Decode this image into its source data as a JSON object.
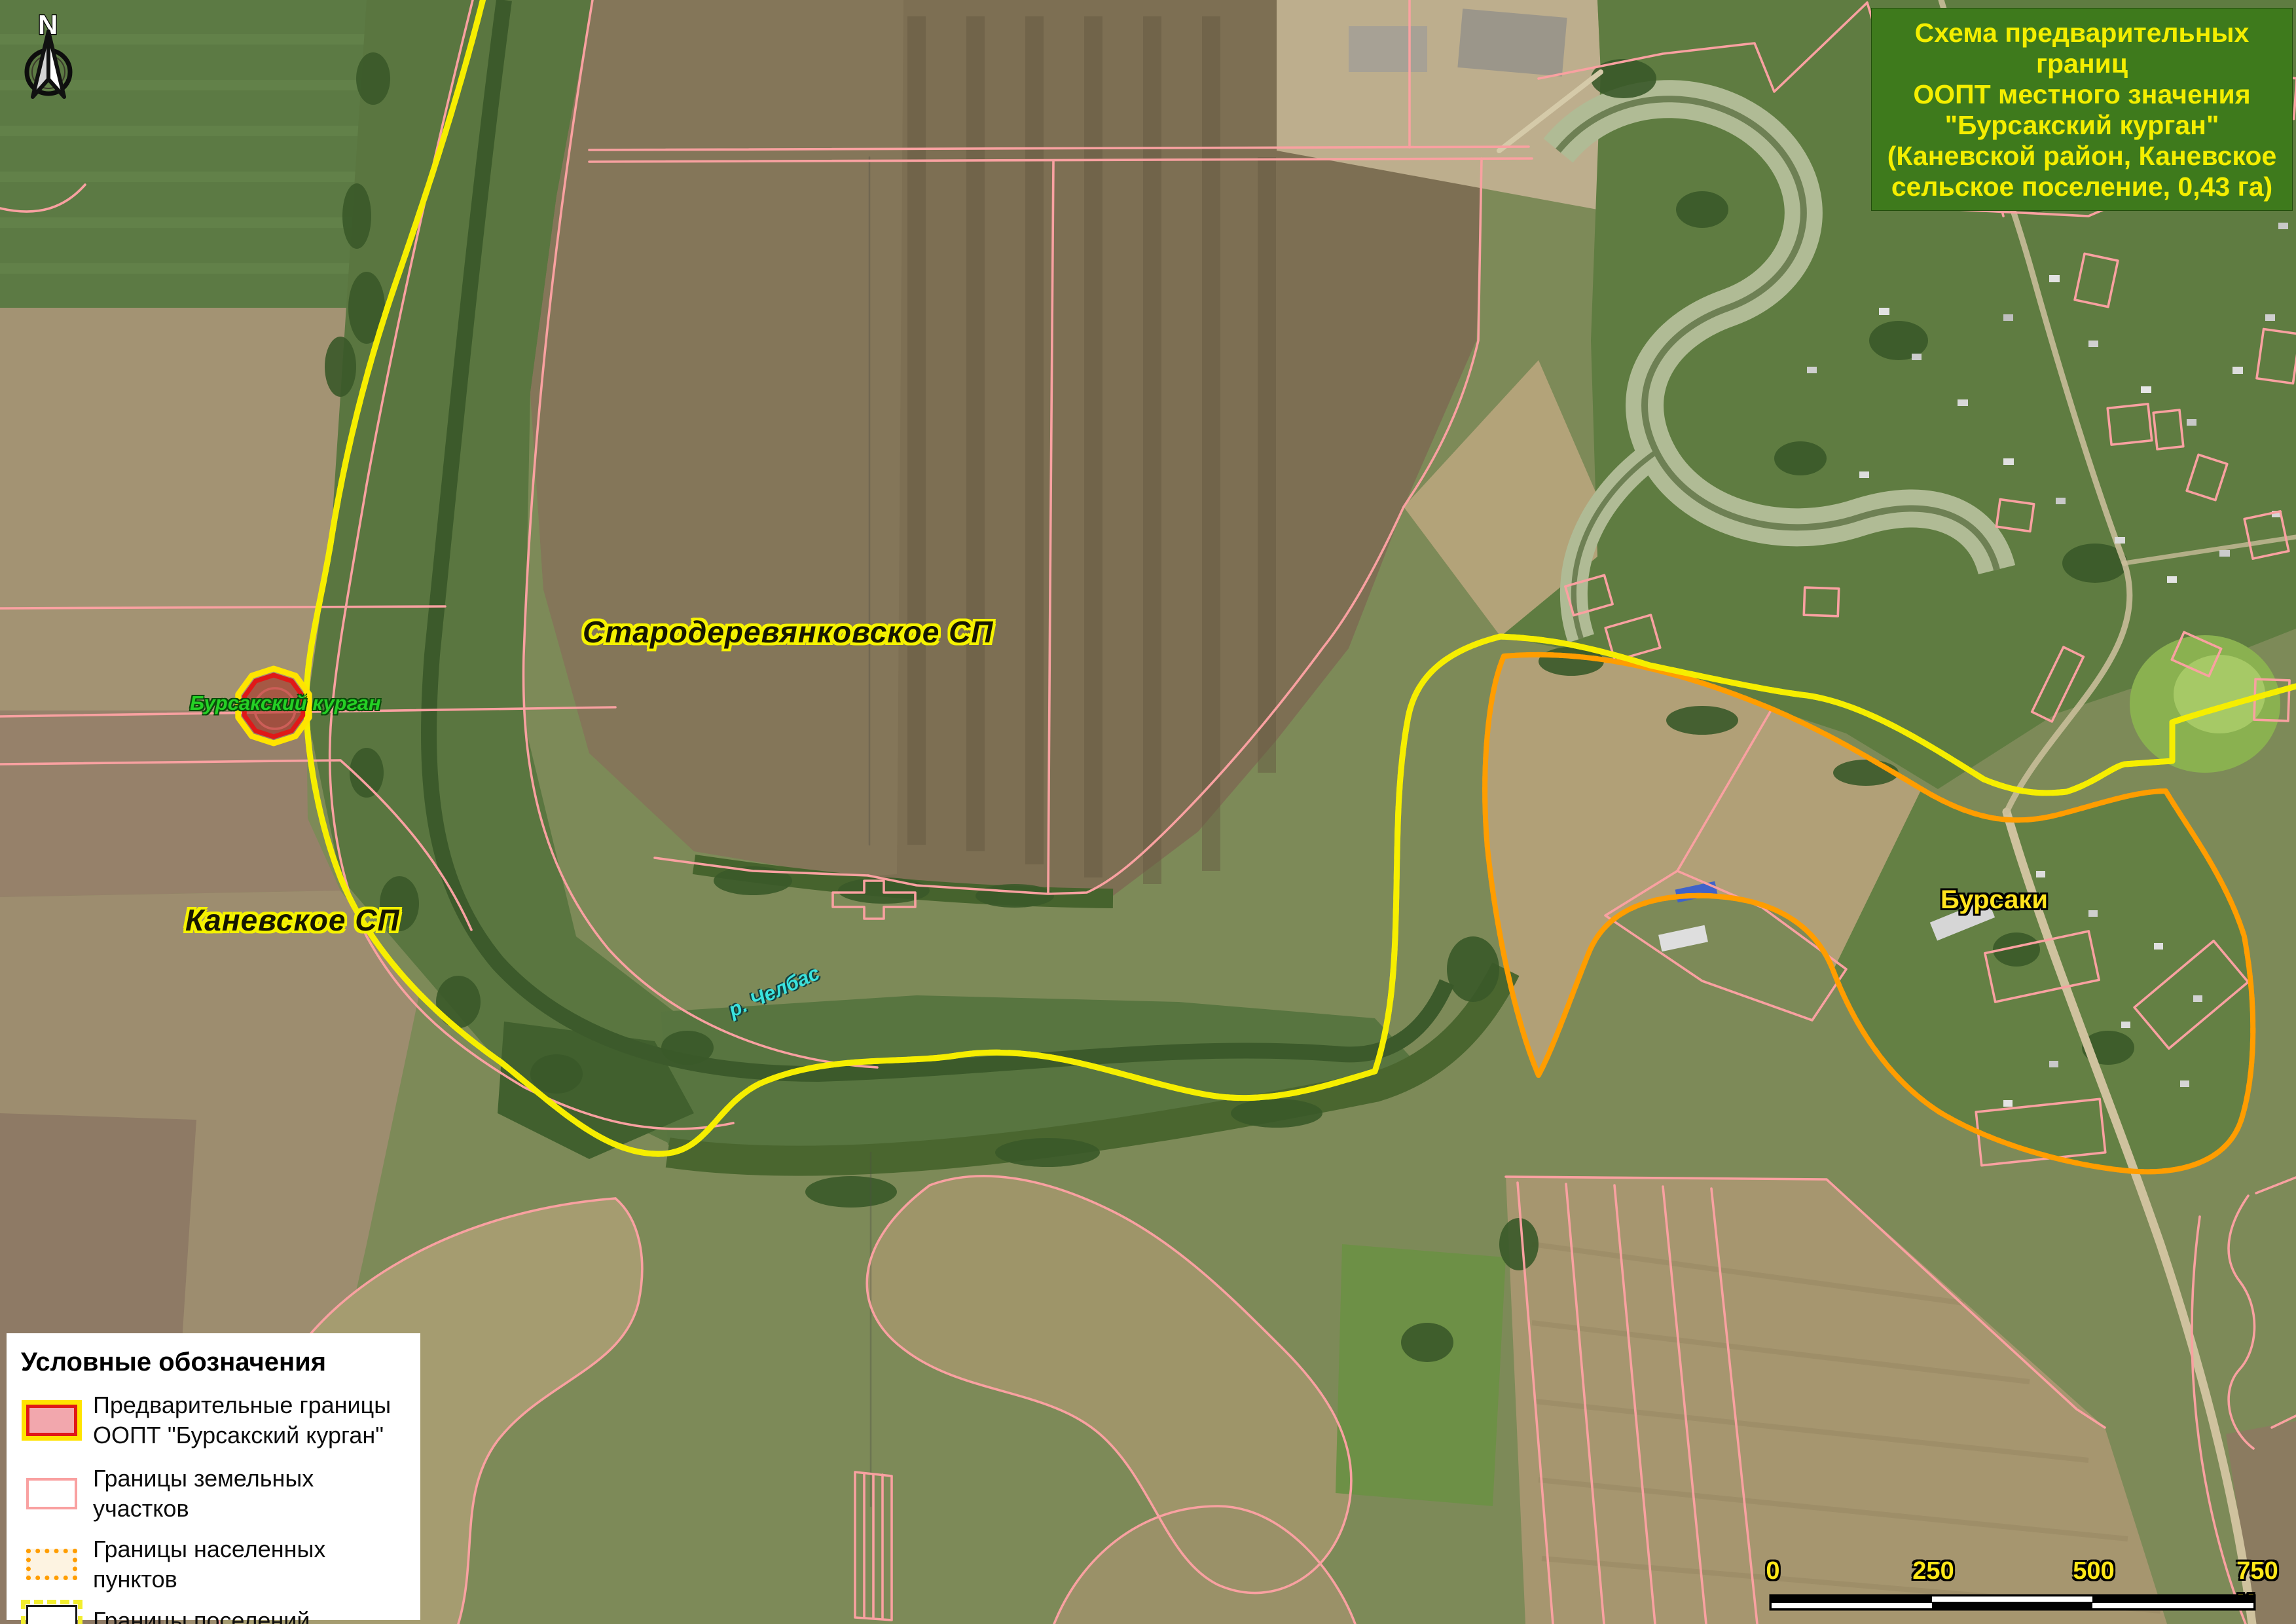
{
  "page": {
    "type": "protected-area-boundary-scheme-map"
  },
  "title_box": {
    "lines": [
      "Схема предварительных границ",
      "ООПТ местного значения",
      "\"Бурсакский курган\"",
      "(Каневской район, Каневское",
      "сельское поселение, 0,43 га)"
    ]
  },
  "north_arrow": {
    "label": "N"
  },
  "map_labels": {
    "settlement_area_1": "Стародеревянковское СП",
    "settlement_area_2": "Каневское СП",
    "oopt_marker": "Бурсакский курган",
    "river": "р. Челбас",
    "village": "Бурсаки"
  },
  "legend": {
    "title": "Условные обозначения",
    "items": [
      {
        "label_line1": "Предварительные границы",
        "label_line2": "ООПТ \"Бурсакский курган\""
      },
      {
        "label_line1": "Границы земельных участков"
      },
      {
        "label_line1": "Границы населенных пунктов"
      },
      {
        "label_line1": "Границы поселений"
      }
    ]
  },
  "scale_bar": {
    "labels": [
      "0",
      "250",
      "500",
      "750 м"
    ]
  },
  "colors": {
    "parcel": "#f9a1a1",
    "muni": "#f6ee00",
    "muni-dash": "#141414",
    "npt": "#ff9d00",
    "npt-dash": "#ffe14d",
    "oopt-outer": "#ffe400",
    "oopt-ring": "#e01818",
    "oopt-fill": "rgba(170,40,30,0.55)",
    "title-bg": "#3e7a1c",
    "title-text": "#f4ee00",
    "label-halo": "#f5f200",
    "kurgan-label": "#25d025",
    "river-label": "#3ae2de",
    "village-label": "#ffe41e",
    "scale-label": "#ffe818"
  }
}
